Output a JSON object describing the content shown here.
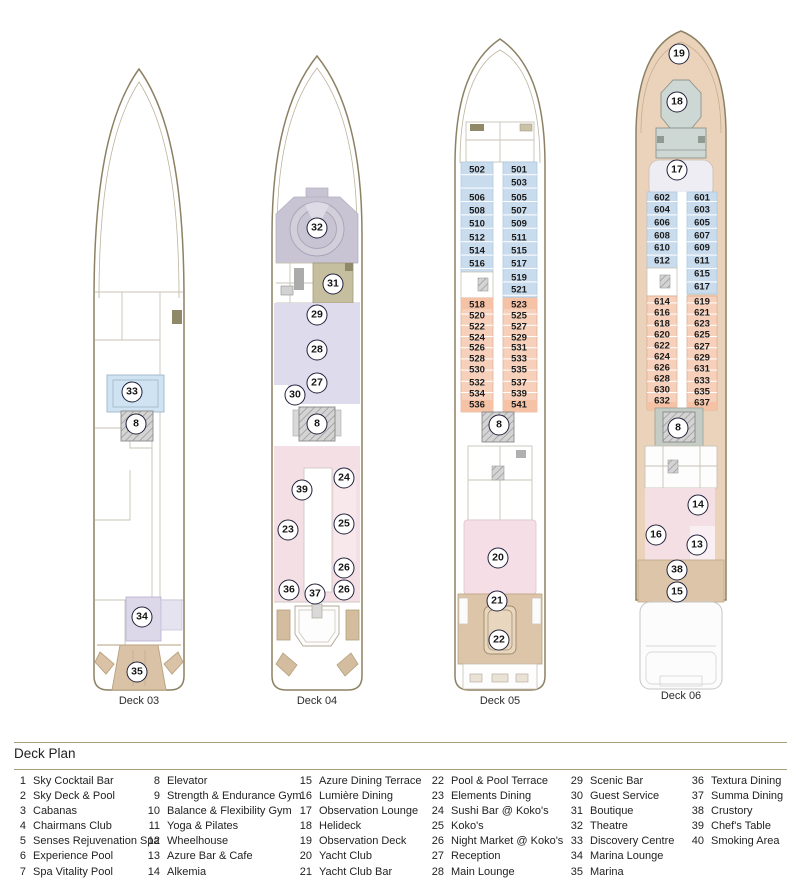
{
  "legend": {
    "title": "Deck Plan",
    "columns": [
      {
        "items": [
          {
            "num": "1",
            "label": "Sky Cocktail Bar"
          },
          {
            "num": "2",
            "label": "Sky Deck & Pool"
          },
          {
            "num": "3",
            "label": "Cabanas"
          },
          {
            "num": "4",
            "label": "Chairmans Club"
          },
          {
            "num": "5",
            "label": "Senses Rejuvenation Spa"
          },
          {
            "num": "6",
            "label": "Experience Pool"
          },
          {
            "num": "7",
            "label": "Spa Vitality Pool"
          }
        ]
      },
      {
        "items": [
          {
            "num": "8",
            "label": "Elevator"
          },
          {
            "num": "9",
            "label": "Strength & Endurance Gym"
          },
          {
            "num": "10",
            "label": "Balance & Flexibility Gym"
          },
          {
            "num": "11",
            "label": "Yoga & Pilates"
          },
          {
            "num": "12",
            "label": "Wheelhouse"
          },
          {
            "num": "13",
            "label": "Azure Bar & Cafe"
          },
          {
            "num": "14",
            "label": "Alkemia"
          }
        ]
      },
      {
        "items": [
          {
            "num": "15",
            "label": "Azure Dining Terrace"
          },
          {
            "num": "16",
            "label": "Lumière Dining"
          },
          {
            "num": "17",
            "label": "Observation Lounge"
          },
          {
            "num": "18",
            "label": "Helideck"
          },
          {
            "num": "19",
            "label": "Observation Deck"
          },
          {
            "num": "20",
            "label": "Yacht Club"
          },
          {
            "num": "21",
            "label": "Yacht Club Bar"
          }
        ]
      },
      {
        "items": [
          {
            "num": "22",
            "label": "Pool & Pool Terrace"
          },
          {
            "num": "23",
            "label": "Elements Dining"
          },
          {
            "num": "24",
            "label": "Sushi Bar @ Koko's"
          },
          {
            "num": "25",
            "label": "Koko's"
          },
          {
            "num": "26",
            "label": "Night Market @ Koko's"
          },
          {
            "num": "27",
            "label": "Reception"
          },
          {
            "num": "28",
            "label": "Main Lounge"
          }
        ]
      },
      {
        "items": [
          {
            "num": "29",
            "label": "Scenic Bar"
          },
          {
            "num": "30",
            "label": "Guest Service"
          },
          {
            "num": "31",
            "label": "Boutique"
          },
          {
            "num": "32",
            "label": "Theatre"
          },
          {
            "num": "33",
            "label": "Discovery Centre"
          },
          {
            "num": "34",
            "label": "Marina Lounge"
          },
          {
            "num": "35",
            "label": "Marina"
          }
        ]
      },
      {
        "items": [
          {
            "num": "36",
            "label": "Textura Dining"
          },
          {
            "num": "37",
            "label": "Summa Dining"
          },
          {
            "num": "38",
            "label": "Crustory"
          },
          {
            "num": "39",
            "label": "Chef's Table"
          },
          {
            "num": "40",
            "label": "Smoking Area"
          }
        ]
      }
    ]
  },
  "decks": [
    {
      "id": "deck-03",
      "label": "Deck 03",
      "label_x": 139,
      "label_y": 695,
      "markers": [
        {
          "n": "33",
          "x": 132,
          "y": 392
        },
        {
          "n": "8",
          "x": 136,
          "y": 424
        },
        {
          "n": "34",
          "x": 142,
          "y": 617
        },
        {
          "n": "35",
          "x": 137,
          "y": 672
        }
      ]
    },
    {
      "id": "deck-04",
      "label": "Deck 04",
      "label_x": 317,
      "label_y": 695,
      "markers": [
        {
          "n": "32",
          "x": 317,
          "y": 228
        },
        {
          "n": "31",
          "x": 333,
          "y": 284
        },
        {
          "n": "29",
          "x": 317,
          "y": 315
        },
        {
          "n": "28",
          "x": 317,
          "y": 350
        },
        {
          "n": "27",
          "x": 317,
          "y": 383
        },
        {
          "n": "30",
          "x": 295,
          "y": 395
        },
        {
          "n": "8",
          "x": 317,
          "y": 424
        },
        {
          "n": "24",
          "x": 344,
          "y": 478
        },
        {
          "n": "39",
          "x": 302,
          "y": 490
        },
        {
          "n": "25",
          "x": 344,
          "y": 524
        },
        {
          "n": "23",
          "x": 288,
          "y": 530
        },
        {
          "n": "26",
          "x": 344,
          "y": 568
        },
        {
          "n": "36",
          "x": 289,
          "y": 590
        },
        {
          "n": "26",
          "x": 344,
          "y": 590
        },
        {
          "n": "37",
          "x": 315,
          "y": 594
        }
      ]
    },
    {
      "id": "deck-05",
      "label": "Deck 05",
      "label_x": 500,
      "label_y": 695,
      "markers": [
        {
          "n": "8",
          "x": 499,
          "y": 425
        },
        {
          "n": "20",
          "x": 498,
          "y": 558
        },
        {
          "n": "21",
          "x": 497,
          "y": 601
        },
        {
          "n": "22",
          "x": 499,
          "y": 640
        }
      ],
      "cabins": [
        {
          "num": "502",
          "x": 477,
          "y": 170
        },
        {
          "num": "501",
          "x": 519,
          "y": 170
        },
        {
          "num": "503",
          "x": 519,
          "y": 183
        },
        {
          "num": "506",
          "x": 477,
          "y": 198
        },
        {
          "num": "505",
          "x": 519,
          "y": 198
        },
        {
          "num": "508",
          "x": 477,
          "y": 211
        },
        {
          "num": "507",
          "x": 519,
          "y": 211
        },
        {
          "num": "510",
          "x": 477,
          "y": 224
        },
        {
          "num": "509",
          "x": 519,
          "y": 224
        },
        {
          "num": "512",
          "x": 477,
          "y": 238
        },
        {
          "num": "511",
          "x": 519,
          "y": 238
        },
        {
          "num": "514",
          "x": 477,
          "y": 251
        },
        {
          "num": "515",
          "x": 519,
          "y": 251
        },
        {
          "num": "516",
          "x": 477,
          "y": 264
        },
        {
          "num": "517",
          "x": 519,
          "y": 264
        },
        {
          "num": "519",
          "x": 519,
          "y": 278
        },
        {
          "num": "521",
          "x": 519,
          "y": 290
        },
        {
          "num": "518",
          "x": 477,
          "y": 305
        },
        {
          "num": "523",
          "x": 519,
          "y": 305
        },
        {
          "num": "520",
          "x": 477,
          "y": 316
        },
        {
          "num": "525",
          "x": 519,
          "y": 316
        },
        {
          "num": "522",
          "x": 477,
          "y": 327
        },
        {
          "num": "527",
          "x": 519,
          "y": 327
        },
        {
          "num": "524",
          "x": 477,
          "y": 338
        },
        {
          "num": "529",
          "x": 519,
          "y": 338
        },
        {
          "num": "526",
          "x": 477,
          "y": 348
        },
        {
          "num": "531",
          "x": 519,
          "y": 348
        },
        {
          "num": "528",
          "x": 477,
          "y": 359
        },
        {
          "num": "533",
          "x": 519,
          "y": 359
        },
        {
          "num": "530",
          "x": 477,
          "y": 370
        },
        {
          "num": "535",
          "x": 519,
          "y": 370
        },
        {
          "num": "532",
          "x": 477,
          "y": 383
        },
        {
          "num": "537",
          "x": 519,
          "y": 383
        },
        {
          "num": "534",
          "x": 477,
          "y": 394
        },
        {
          "num": "539",
          "x": 519,
          "y": 394
        },
        {
          "num": "536",
          "x": 477,
          "y": 405
        },
        {
          "num": "541",
          "x": 519,
          "y": 405
        }
      ]
    },
    {
      "id": "deck-06",
      "label": "Deck 06",
      "label_x": 681,
      "label_y": 690,
      "markers": [
        {
          "n": "19",
          "x": 679,
          "y": 54
        },
        {
          "n": "18",
          "x": 677,
          "y": 102
        },
        {
          "n": "17",
          "x": 677,
          "y": 170
        },
        {
          "n": "8",
          "x": 678,
          "y": 428
        },
        {
          "n": "14",
          "x": 698,
          "y": 505
        },
        {
          "n": "16",
          "x": 656,
          "y": 535
        },
        {
          "n": "13",
          "x": 697,
          "y": 545
        },
        {
          "n": "38",
          "x": 677,
          "y": 570
        },
        {
          "n": "15",
          "x": 677,
          "y": 592
        }
      ],
      "cabins": [
        {
          "num": "602",
          "x": 662,
          "y": 198
        },
        {
          "num": "601",
          "x": 702,
          "y": 198
        },
        {
          "num": "604",
          "x": 662,
          "y": 210
        },
        {
          "num": "603",
          "x": 702,
          "y": 210
        },
        {
          "num": "606",
          "x": 662,
          "y": 223
        },
        {
          "num": "605",
          "x": 702,
          "y": 223
        },
        {
          "num": "608",
          "x": 662,
          "y": 236
        },
        {
          "num": "607",
          "x": 702,
          "y": 236
        },
        {
          "num": "610",
          "x": 662,
          "y": 248
        },
        {
          "num": "609",
          "x": 702,
          "y": 248
        },
        {
          "num": "612",
          "x": 662,
          "y": 261
        },
        {
          "num": "611",
          "x": 702,
          "y": 261
        },
        {
          "num": "615",
          "x": 702,
          "y": 274
        },
        {
          "num": "617",
          "x": 702,
          "y": 287
        },
        {
          "num": "614",
          "x": 662,
          "y": 302
        },
        {
          "num": "619",
          "x": 702,
          "y": 302
        },
        {
          "num": "616",
          "x": 662,
          "y": 313
        },
        {
          "num": "621",
          "x": 702,
          "y": 313
        },
        {
          "num": "618",
          "x": 662,
          "y": 324
        },
        {
          "num": "623",
          "x": 702,
          "y": 324
        },
        {
          "num": "620",
          "x": 662,
          "y": 335
        },
        {
          "num": "625",
          "x": 702,
          "y": 335
        },
        {
          "num": "622",
          "x": 662,
          "y": 346
        },
        {
          "num": "627",
          "x": 702,
          "y": 347
        },
        {
          "num": "624",
          "x": 662,
          "y": 357
        },
        {
          "num": "629",
          "x": 702,
          "y": 358
        },
        {
          "num": "626",
          "x": 662,
          "y": 368
        },
        {
          "num": "631",
          "x": 702,
          "y": 369
        },
        {
          "num": "628",
          "x": 662,
          "y": 379
        },
        {
          "num": "633",
          "x": 702,
          "y": 381
        },
        {
          "num": "630",
          "x": 662,
          "y": 390
        },
        {
          "num": "635",
          "x": 702,
          "y": 392
        },
        {
          "num": "632",
          "x": 662,
          "y": 401
        },
        {
          "num": "637",
          "x": 702,
          "y": 403
        }
      ]
    }
  ],
  "palette": {
    "hull_outline": "#8d8164",
    "cabin_blue": "#c9dcee",
    "cabin_peach": "#f6d0ba",
    "cabin_orange": "#f5c2a6",
    "dining_pink": "#f4dfe5",
    "lounge_lavender": "#dedbec",
    "theatre_gray": "#c8c4d4",
    "boutique_olive": "#c5bfa0",
    "terrace_tan": "#dcc5a9",
    "deck6_hull_tan": "#ead3ba",
    "helideck_gray": "#cdd7d3",
    "discovery_blue": "#cfe3f2",
    "marina_lounge_lavender": "#dcd8ea",
    "marina_tan": "#d9c2a5",
    "rule_olive": "#a79d7c"
  }
}
